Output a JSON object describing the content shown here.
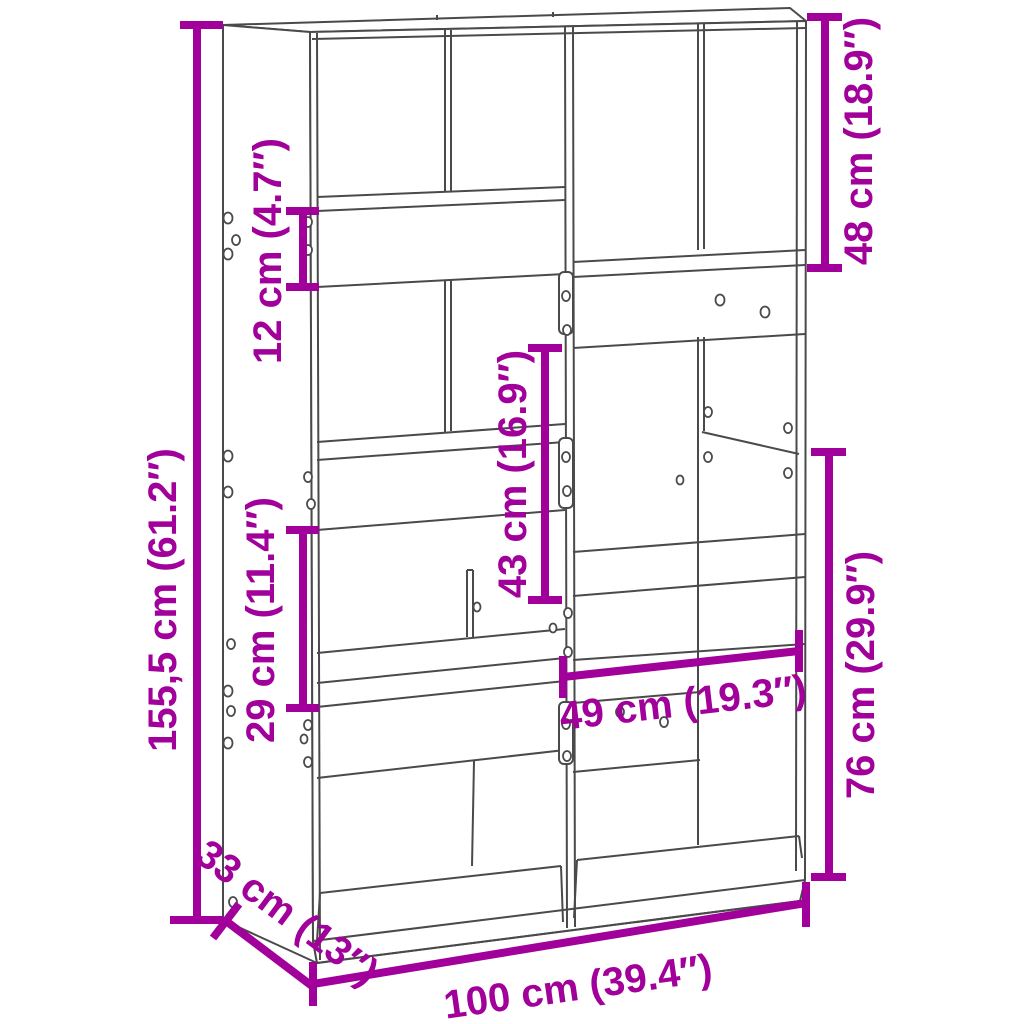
{
  "figure": {
    "type": "product-dimension-diagram",
    "subject": "bookcase room divider line drawing",
    "background": "#ffffff"
  },
  "colors": {
    "dimension_accent": "#a1009a",
    "drawing_lines": "#4a4a4a"
  },
  "dimensions": {
    "total_height": {
      "label": "155,5 cm (61.2″)",
      "value_cm": "155,5",
      "value_in": "61.2"
    },
    "shelf_band_height": {
      "label": "12 cm (4.7″)",
      "value_cm": "12",
      "value_in": "4.7"
    },
    "left_compartment": {
      "label": "29 cm (11.4″)",
      "value_cm": "29",
      "value_in": "11.4"
    },
    "center_compartment": {
      "label": "43 cm (16.9″)",
      "value_cm": "43",
      "value_in": "16.9"
    },
    "top_right_compartment": {
      "label": "48 cm (18.9″)",
      "value_cm": "48",
      "value_in": "18.9"
    },
    "right_lower_section": {
      "label": "76 cm (29.9″)",
      "value_cm": "76",
      "value_in": "29.9"
    },
    "right_inner_width": {
      "label": "49 cm (19.3″)",
      "value_cm": "49",
      "value_in": "19.3"
    },
    "depth": {
      "label": "33 cm (13″)",
      "value_cm": "33",
      "value_in": "13"
    },
    "total_width": {
      "label": "100 cm (39.4″)",
      "value_cm": "100",
      "value_in": "39.4"
    }
  }
}
